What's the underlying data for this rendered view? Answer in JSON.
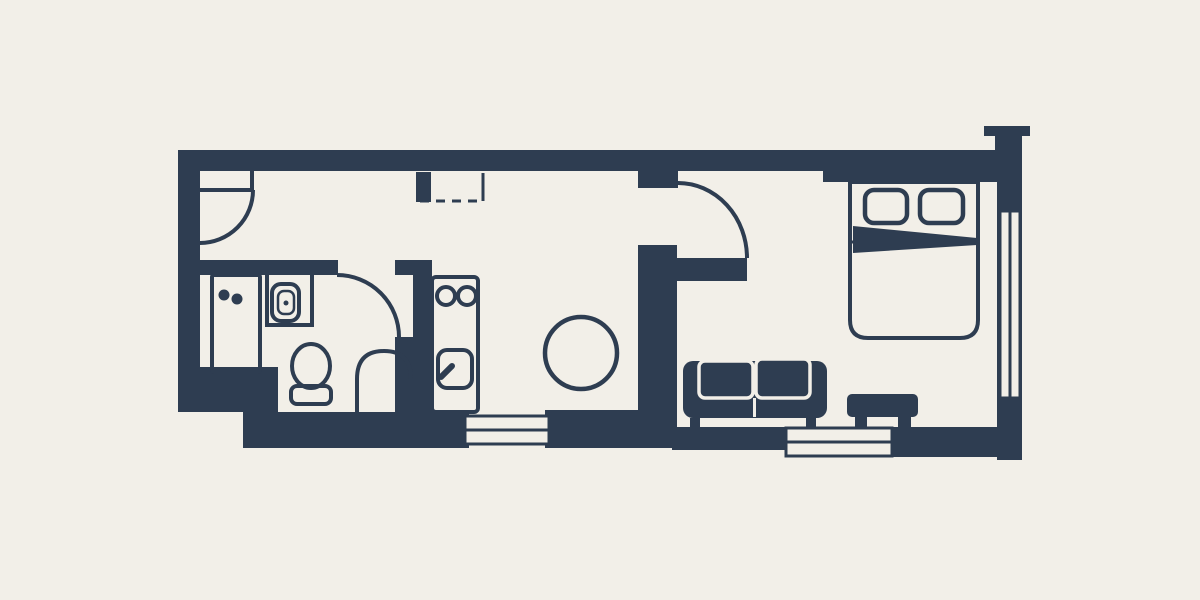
{
  "scene": {
    "type": "floor-plan",
    "description": "Stylized studio apartment floor plan, dark navy walls and furniture silhouettes on a cream background, no text labels"
  },
  "colors": {
    "background": "#f2efe8",
    "wall": "#2e3d51"
  },
  "rooms": [
    {
      "name": "bathroom",
      "fixtures": [
        "washing-machine",
        "vanity-counter",
        "vanity-sink",
        "toilet",
        "shower-arch",
        "bathroom-swing-door"
      ]
    },
    {
      "name": "kitchen-hallway",
      "fixtures": [
        "entry-swing-door",
        "dashed-closet",
        "kitchen-unit",
        "stove-two-burners",
        "kitchen-sink",
        "round-table"
      ]
    },
    {
      "name": "living-area",
      "fixtures": [
        "two-seat-sofa",
        "ottoman",
        "living-swing-door"
      ]
    },
    {
      "name": "bedroom",
      "fixtures": [
        "double-bed",
        "pillow-left",
        "pillow-right",
        "folded-blanket"
      ]
    }
  ],
  "openings": {
    "windows": [
      "bottom-wall-window-left",
      "bottom-wall-window-right",
      "right-wall-window"
    ],
    "doors": [
      "entry-door",
      "bathroom-door",
      "living-room-door"
    ],
    "other": [
      "chimney-top-right"
    ]
  }
}
